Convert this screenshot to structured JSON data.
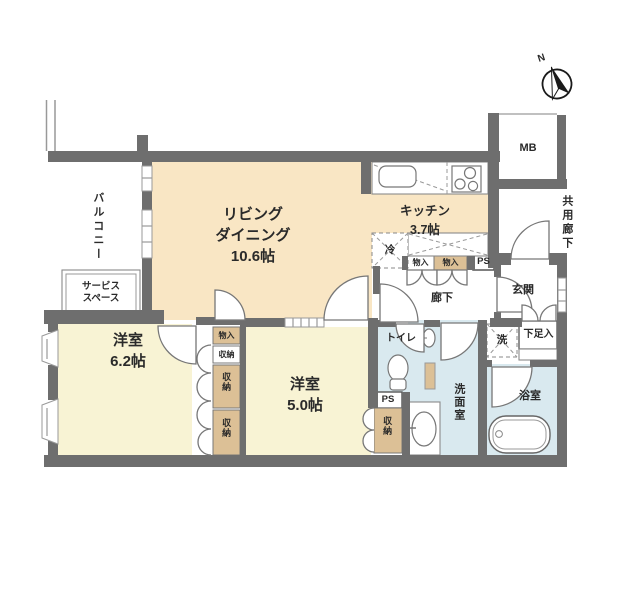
{
  "title": "apartment-floor-plan",
  "colors": {
    "wall": "#6e6e6e",
    "living": "#f9e6c4",
    "bedroom": "#f8f3d4",
    "closet": "#dcc096",
    "wet": "#d9e9ef",
    "line": "#9a9a9a"
  },
  "labels": {
    "living_1": "リビング",
    "living_2": "ダイニング",
    "living_size": "10.6帖",
    "kitchen": "キッチン",
    "kitchen_size": "3.7帖",
    "bedroom1": "洋室",
    "bedroom1_size": "6.2帖",
    "bedroom2": "洋室",
    "bedroom2_size": "5.0帖",
    "balcony": "バルコニー",
    "service_1": "サービス",
    "service_2": "スペース",
    "common_corridor": "共用廊下",
    "meter_box": "MB",
    "entrance": "玄関",
    "hallway": "廊下",
    "toilet": "トイレ",
    "washroom": "洗面室",
    "bathroom": "浴室",
    "shoe_cabinet": "下足入",
    "washer": "洗",
    "fridge": "冷",
    "pipe_space": "PS",
    "storage": "物入",
    "closet": "収納",
    "compass_north": "N"
  }
}
